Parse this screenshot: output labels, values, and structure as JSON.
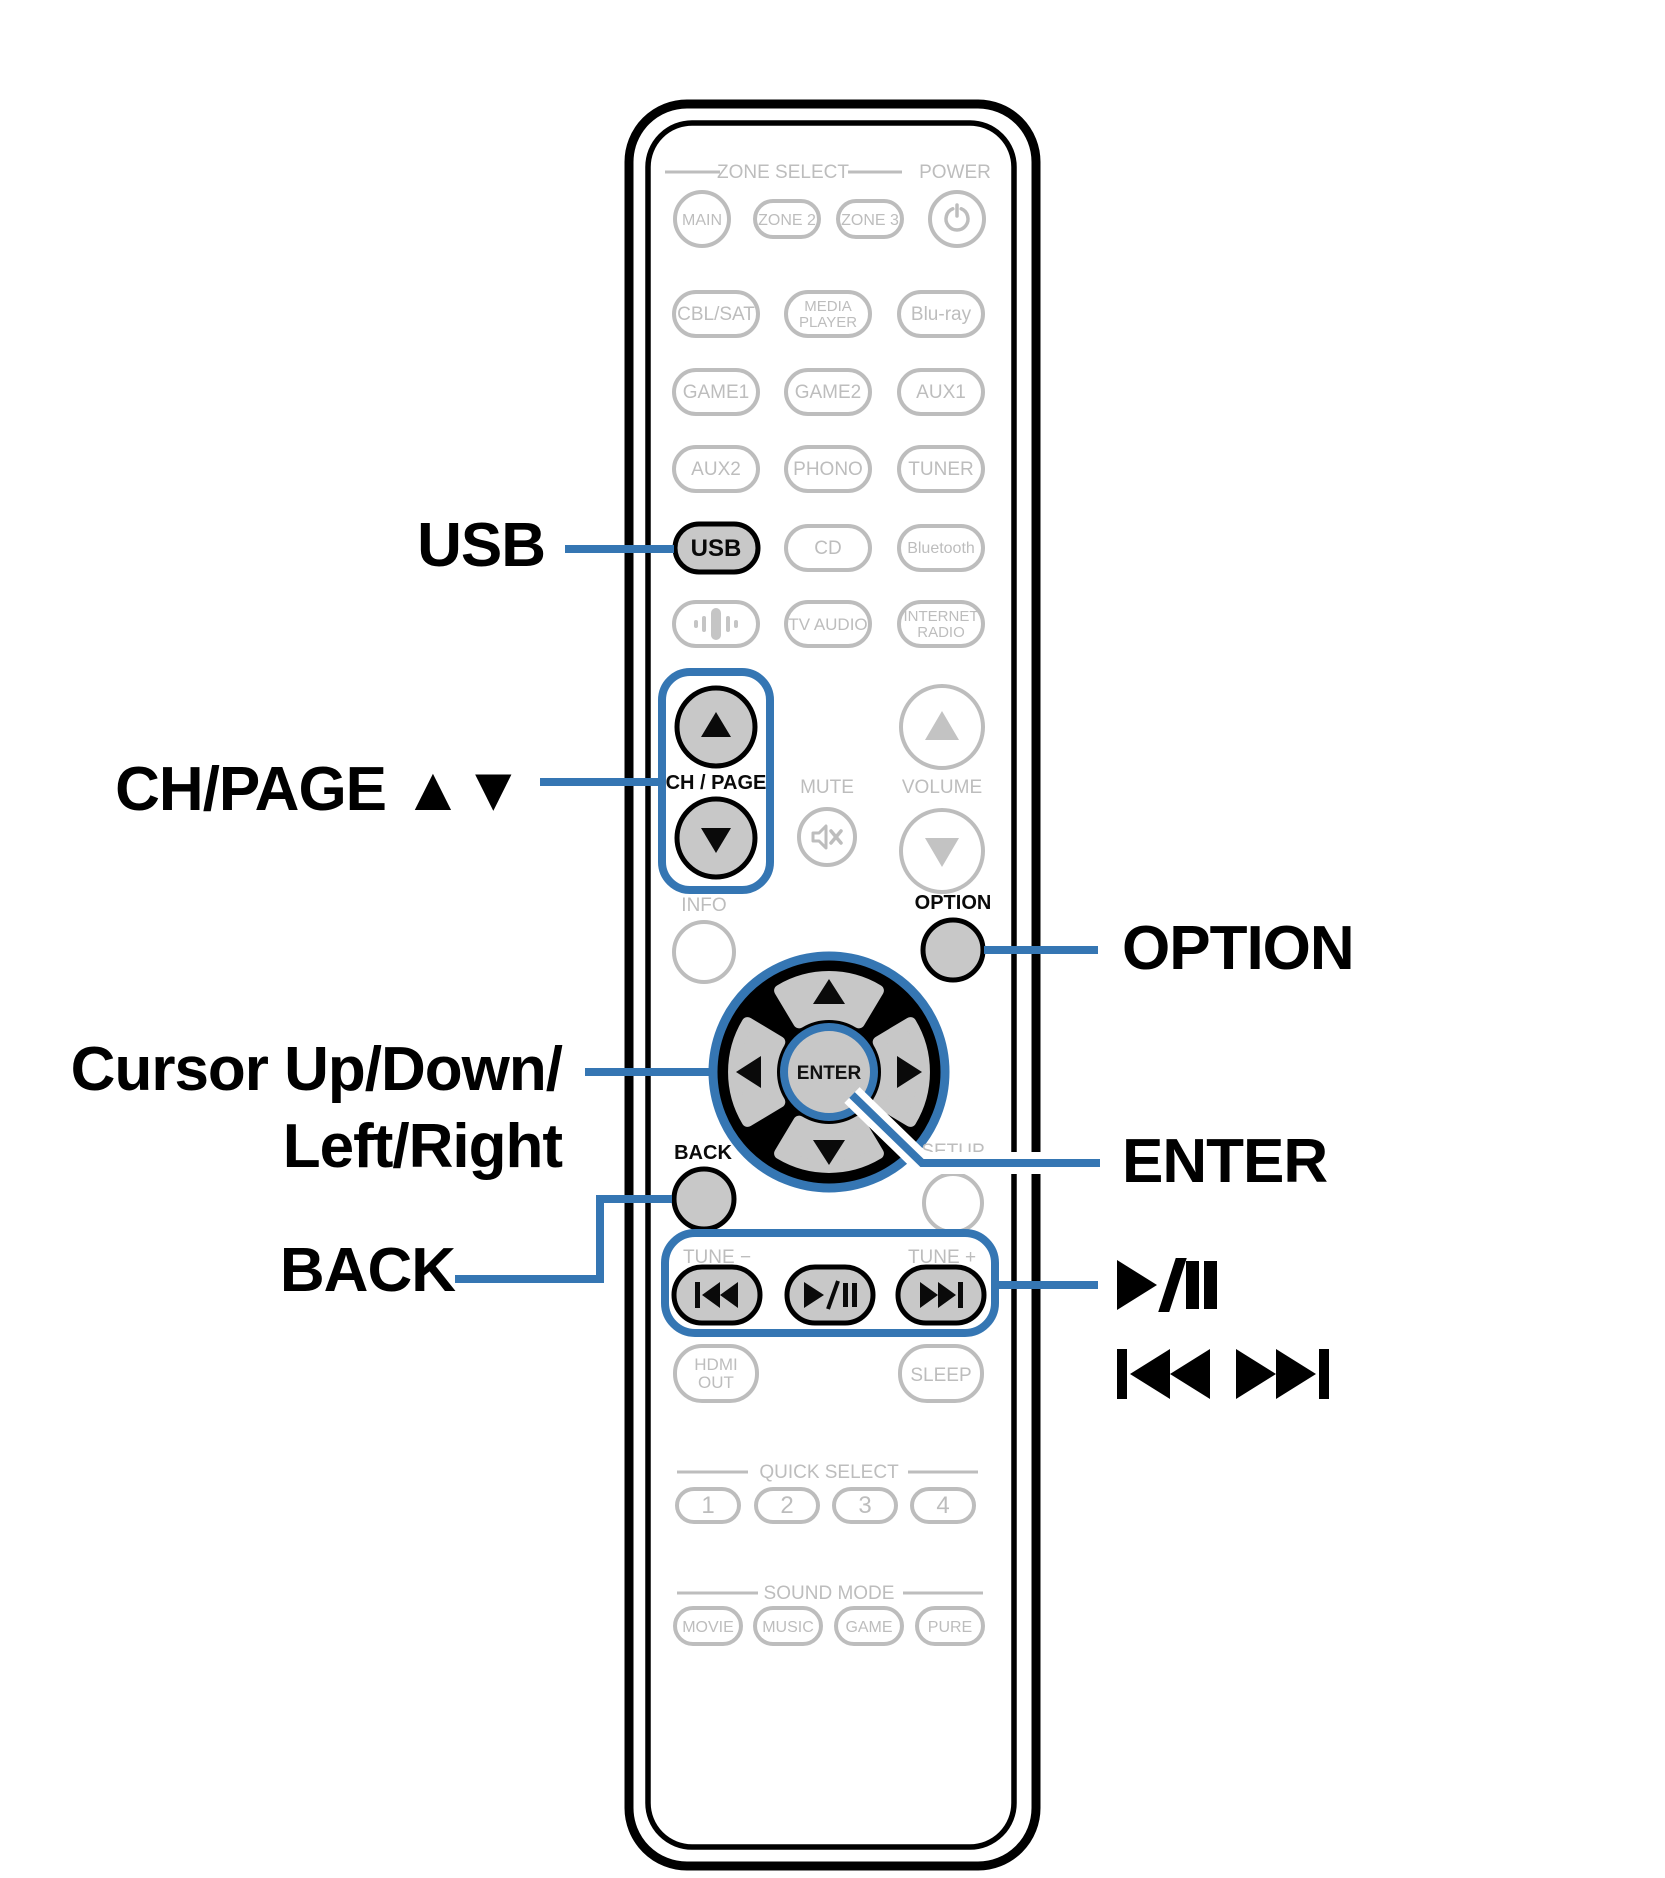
{
  "colors": {
    "accent_blue": "#3576b3",
    "button_fill_gray": "#c8c8c8",
    "outline_gray": "#bdbdbd",
    "black": "#0a0a0a",
    "background": "#ffffff"
  },
  "labels": {
    "left": {
      "usb": "USB",
      "ch_page": "CH/PAGE ▲▼",
      "cursor_line1": "Cursor Up/Down/",
      "cursor_line2": "Left/Right",
      "back": "BACK"
    },
    "right": {
      "option": "OPTION",
      "enter": "ENTER",
      "play_pause": "►/❚❚",
      "skip": "❙◄◄ ►►❙"
    }
  },
  "remote": {
    "headers": {
      "zone_select": "ZONE SELECT",
      "power": "POWER",
      "quick_select": "QUICK SELECT",
      "sound_mode": "SOUND MODE"
    },
    "buttons": {
      "main": "MAIN",
      "zone2": "ZONE 2",
      "zone3": "ZONE 3",
      "cbl_sat": "CBL/SAT",
      "media_player_line1": "MEDIA",
      "media_player_line2": "PLAYER",
      "blu_ray": "Blu-ray",
      "game1": "GAME1",
      "game2": "GAME2",
      "aux1": "AUX1",
      "aux2": "AUX2",
      "phono": "PHONO",
      "tuner": "TUNER",
      "usb": "USB",
      "cd": "CD",
      "bluetooth": "Bluetooth",
      "tv_audio": "TV AUDIO",
      "internet_radio_line1": "INTERNET",
      "internet_radio_line2": "RADIO",
      "ch_page": "CH / PAGE",
      "mute": "MUTE",
      "volume": "VOLUME",
      "info": "INFO",
      "option": "OPTION",
      "enter": "ENTER",
      "back": "BACK",
      "setup": "SETUP",
      "tune_minus": "TUNE −",
      "tune_plus": "TUNE +",
      "hdmi_out_line1": "HDMI",
      "hdmi_out_line2": "OUT",
      "sleep": "SLEEP",
      "quick_1": "1",
      "quick_2": "2",
      "quick_3": "3",
      "quick_4": "4",
      "movie": "MOVIE",
      "music": "MUSIC",
      "game": "GAME",
      "pure": "PURE"
    },
    "icons": {
      "power": "⏻",
      "mute": "🔇",
      "audio_waveform": "|||",
      "ch_page_up": "▲",
      "ch_page_down": "▼",
      "volume_up": "▲",
      "volume_down": "▼",
      "cursor_up": "▲",
      "cursor_down": "▼",
      "cursor_left": "◄",
      "cursor_right": "►",
      "skip_back": "❙◄◄",
      "play_pause": "►/❚❚",
      "skip_forward": "►►❙"
    }
  }
}
